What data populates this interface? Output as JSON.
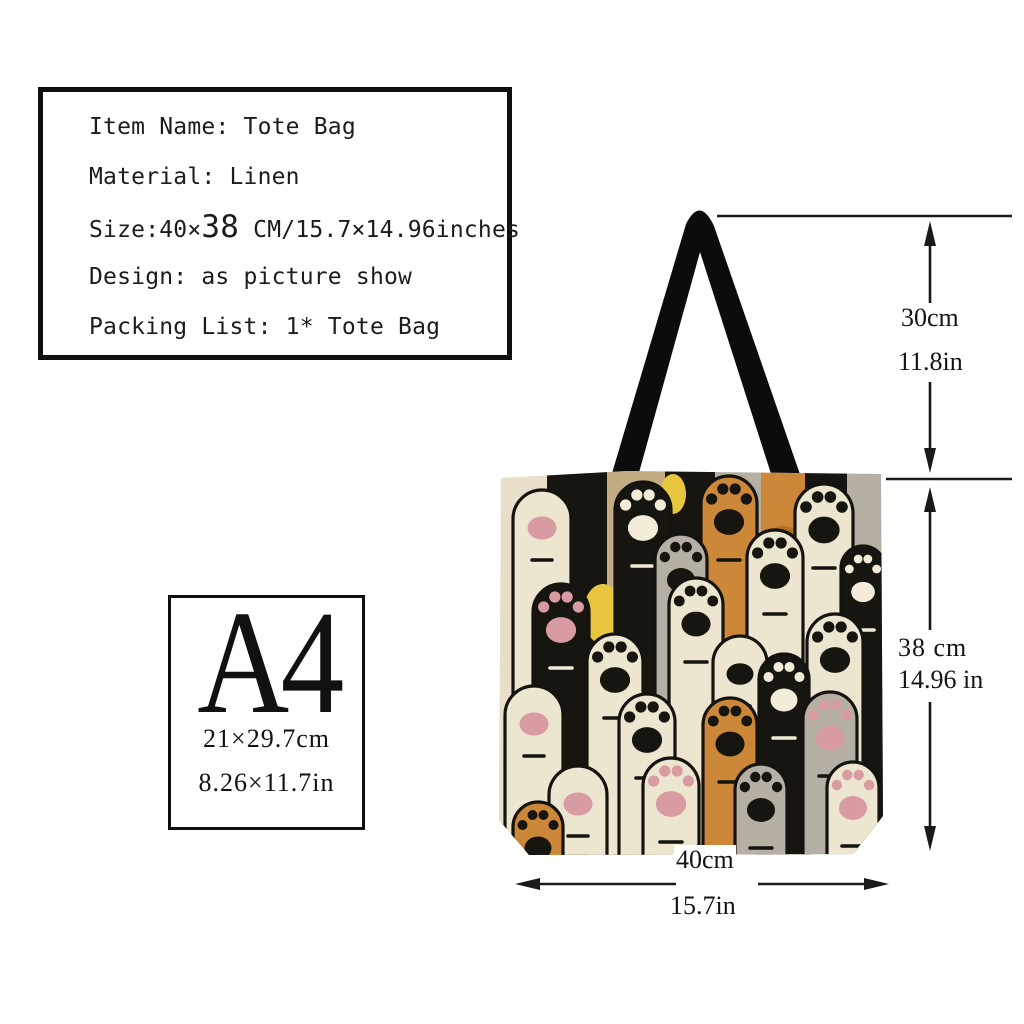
{
  "product_info": {
    "item_line": "Item Name: Tote Bag",
    "material_line": "Material: Linen",
    "size_prefix": "Size:40×",
    "size_big": "38",
    "size_suffix": " CM/15.7×14.96inches",
    "design_line": "Design: as picture show",
    "packing_line": "Packing List: 1* Tote Bag"
  },
  "a4_reference": {
    "title": "A4",
    "size_cm": "21×29.7cm",
    "size_in": "8.26×11.7in"
  },
  "dimensions": {
    "handle_drop_cm": "30cm",
    "handle_drop_in": "11.8in",
    "height_cm": "38 cm",
    "height_in": "14.96 in",
    "width_cm": "40cm",
    "width_in": "15.7in"
  },
  "bag": {
    "palette": {
      "base": "#e7dfca",
      "cream": "#ece5d0",
      "black": "#17150f",
      "tan": "#c3ac84",
      "gray": "#b6b0a4",
      "orange": "#cd8739",
      "pink": "#d89ba1",
      "white": "#f3ecd8",
      "yellow": "#e8c53e",
      "orangedark": "#b4701f",
      "graydark": "#9d968a",
      "outline": "#14130f",
      "handle": "#0c0c0c"
    },
    "stripes": [
      {
        "x": 0,
        "w": 50,
        "c": "base"
      },
      {
        "x": 50,
        "w": 60,
        "c": "black"
      },
      {
        "x": 110,
        "w": 58,
        "c": "tan"
      },
      {
        "x": 168,
        "w": 50,
        "c": "black"
      },
      {
        "x": 218,
        "w": 46,
        "c": "gray"
      },
      {
        "x": 264,
        "w": 44,
        "c": "orange"
      },
      {
        "x": 308,
        "w": 42,
        "c": "black"
      },
      {
        "x": 350,
        "w": 36,
        "c": "gray"
      }
    ],
    "accents": [
      {
        "x": 176,
        "y": 28,
        "rx": 13,
        "ry": 20,
        "c": "yellow"
      },
      {
        "x": 106,
        "y": 148,
        "rx": 20,
        "ry": 30,
        "c": "yellow"
      },
      {
        "x": 240,
        "y": 178,
        "rx": 16,
        "ry": 26,
        "c": "yellow"
      },
      {
        "x": 62,
        "y": 346,
        "rx": 20,
        "ry": 28,
        "c": "yellow"
      },
      {
        "x": 372,
        "y": 348,
        "rx": 16,
        "ry": 24,
        "c": "yellow"
      },
      {
        "x": 286,
        "y": 70,
        "rx": 15,
        "ry": 10,
        "c": "orangedark"
      },
      {
        "x": 288,
        "y": 130,
        "rx": 13,
        "ry": 8,
        "c": "orangedark"
      },
      {
        "x": 284,
        "y": 190,
        "rx": 14,
        "ry": 9,
        "c": "orangedark"
      },
      {
        "x": 240,
        "y": 64,
        "rx": 12,
        "ry": 18,
        "c": "graydark"
      },
      {
        "x": 240,
        "y": 120,
        "rx": 11,
        "ry": 16,
        "c": "graydark"
      },
      {
        "x": 368,
        "y": 120,
        "rx": 13,
        "ry": 20,
        "c": "graydark"
      },
      {
        "x": 371,
        "y": 198,
        "rx": 13,
        "ry": 20,
        "c": "graydark"
      }
    ],
    "paws": [
      {
        "x": 16,
        "y": 24,
        "w": 58,
        "b": "cream",
        "p": "pink",
        "s": "pad"
      },
      {
        "x": 118,
        "y": 16,
        "w": 56,
        "b": "black",
        "p": "white",
        "s": "toes"
      },
      {
        "x": 204,
        "y": 10,
        "w": 56,
        "b": "orange",
        "p": "black",
        "s": "toes"
      },
      {
        "x": 298,
        "y": 18,
        "w": 58,
        "b": "cream",
        "p": "black",
        "s": "toes"
      },
      {
        "x": 158,
        "y": 68,
        "w": 52,
        "b": "gray",
        "p": "black",
        "s": "toes"
      },
      {
        "x": 250,
        "y": 64,
        "w": 56,
        "b": "cream",
        "p": "black",
        "s": "toes"
      },
      {
        "x": 344,
        "y": 80,
        "w": 44,
        "b": "black",
        "p": "white",
        "s": "toes"
      },
      {
        "x": 36,
        "y": 118,
        "w": 56,
        "b": "black",
        "p": "pink",
        "s": "toes"
      },
      {
        "x": 172,
        "y": 112,
        "w": 54,
        "b": "cream",
        "p": "black",
        "s": "toes"
      },
      {
        "x": 310,
        "y": 148,
        "w": 56,
        "b": "cream",
        "p": "black",
        "s": "toes"
      },
      {
        "x": 90,
        "y": 168,
        "w": 56,
        "b": "cream",
        "p": "black",
        "s": "toes"
      },
      {
        "x": 216,
        "y": 170,
        "w": 54,
        "b": "cream",
        "p": "black",
        "s": "pad"
      },
      {
        "x": 262,
        "y": 188,
        "w": 50,
        "b": "black",
        "p": "white",
        "s": "toes"
      },
      {
        "x": 8,
        "y": 220,
        "w": 58,
        "b": "cream",
        "p": "pink",
        "s": "pad"
      },
      {
        "x": 122,
        "y": 228,
        "w": 56,
        "b": "cream",
        "p": "black",
        "s": "toes"
      },
      {
        "x": 206,
        "y": 232,
        "w": 54,
        "b": "orange",
        "p": "black",
        "s": "toes"
      },
      {
        "x": 306,
        "y": 226,
        "w": 54,
        "b": "gray",
        "p": "pink",
        "s": "toes"
      },
      {
        "x": 52,
        "y": 300,
        "w": 58,
        "b": "cream",
        "p": "pink",
        "s": "pad"
      },
      {
        "x": 146,
        "y": 292,
        "w": 56,
        "b": "cream",
        "p": "pink",
        "s": "toes"
      },
      {
        "x": 238,
        "y": 298,
        "w": 52,
        "b": "gray",
        "p": "black",
        "s": "toes"
      },
      {
        "x": 16,
        "y": 336,
        "w": 50,
        "b": "orange",
        "p": "black",
        "s": "toes"
      },
      {
        "x": 330,
        "y": 296,
        "w": 52,
        "b": "cream",
        "p": "pink",
        "s": "toes"
      }
    ]
  }
}
